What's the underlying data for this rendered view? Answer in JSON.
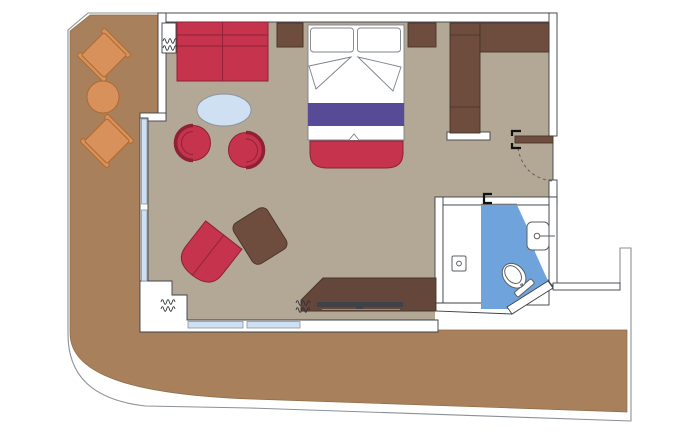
{
  "title": "Suite floor plan with wraparound balcony",
  "colors": {
    "hull": "#8a9097",
    "deck": "#a8815c",
    "deck_edge": "#8d6a45",
    "floor": "#b3a795",
    "wall_fill": "#ffffff",
    "wall_line": "#3c4046",
    "wood_dark": "#6e4c3e",
    "wood_darker": "#64463a",
    "wood_outline": "#46352b",
    "red": "#c5334c",
    "red_outline": "#8e2136",
    "purple": "#574a96",
    "glass": "#cfe0f3",
    "glass_line": "#8a93a0",
    "table_blue": "#cfe0f3",
    "bath_blue": "#6fa3dc",
    "fixture": "#5b6066",
    "orange": "#d9915b",
    "orange_outline": "#ad6931",
    "curtain": "#2f3338",
    "linen_line": "#7d838b",
    "tv": "#3f4347"
  },
  "rooms": [
    "balcony",
    "living-bedroom",
    "entry",
    "bathroom",
    "aft-deck"
  ],
  "furniture": [
    "balcony-chair",
    "balcony-table",
    "balcony-chair",
    "sofa",
    "side-table",
    "coffee-table",
    "tub-chair",
    "tub-chair",
    "chaise-chair",
    "ottoman",
    "double-bed",
    "bed-bench",
    "nightstand",
    "wardrobe",
    "desk",
    "tv",
    "toilet",
    "sink",
    "shower-panel",
    "entry-door"
  ]
}
